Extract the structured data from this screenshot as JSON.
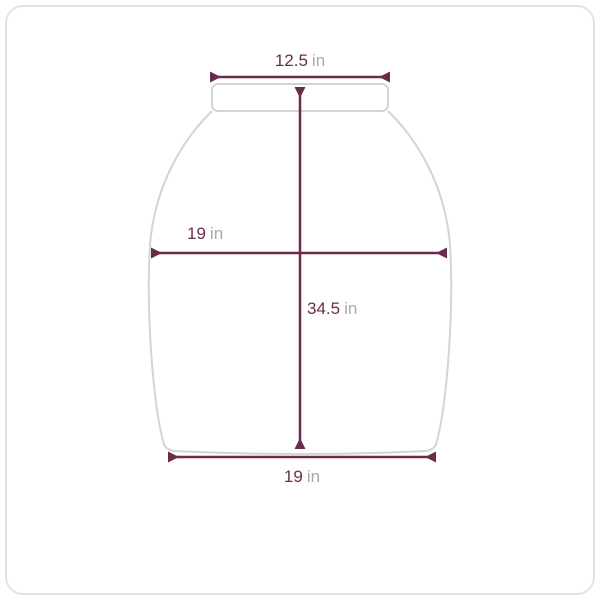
{
  "page": {
    "background": "#ffffff"
  },
  "card": {
    "border_color": "#e2e2e2",
    "corner_radius_px": 18
  },
  "diagram": {
    "type": "product-dimensions",
    "shape": "tapered-vessel-silhouette-with-rim",
    "unit": "in",
    "colors": {
      "dimension_line": "#6b2c4c",
      "value_text": "#6b2c4c",
      "unit_text": "#a9a9a9",
      "shape_outline": "#d4d4d4"
    },
    "measurements": {
      "top_width": {
        "value": "12.5",
        "unit": "in"
      },
      "mid_width": {
        "value": "19",
        "unit": "in"
      },
      "height": {
        "value": "34.5",
        "unit": "in"
      },
      "bottom_width": {
        "value": "19",
        "unit": "in"
      }
    }
  }
}
